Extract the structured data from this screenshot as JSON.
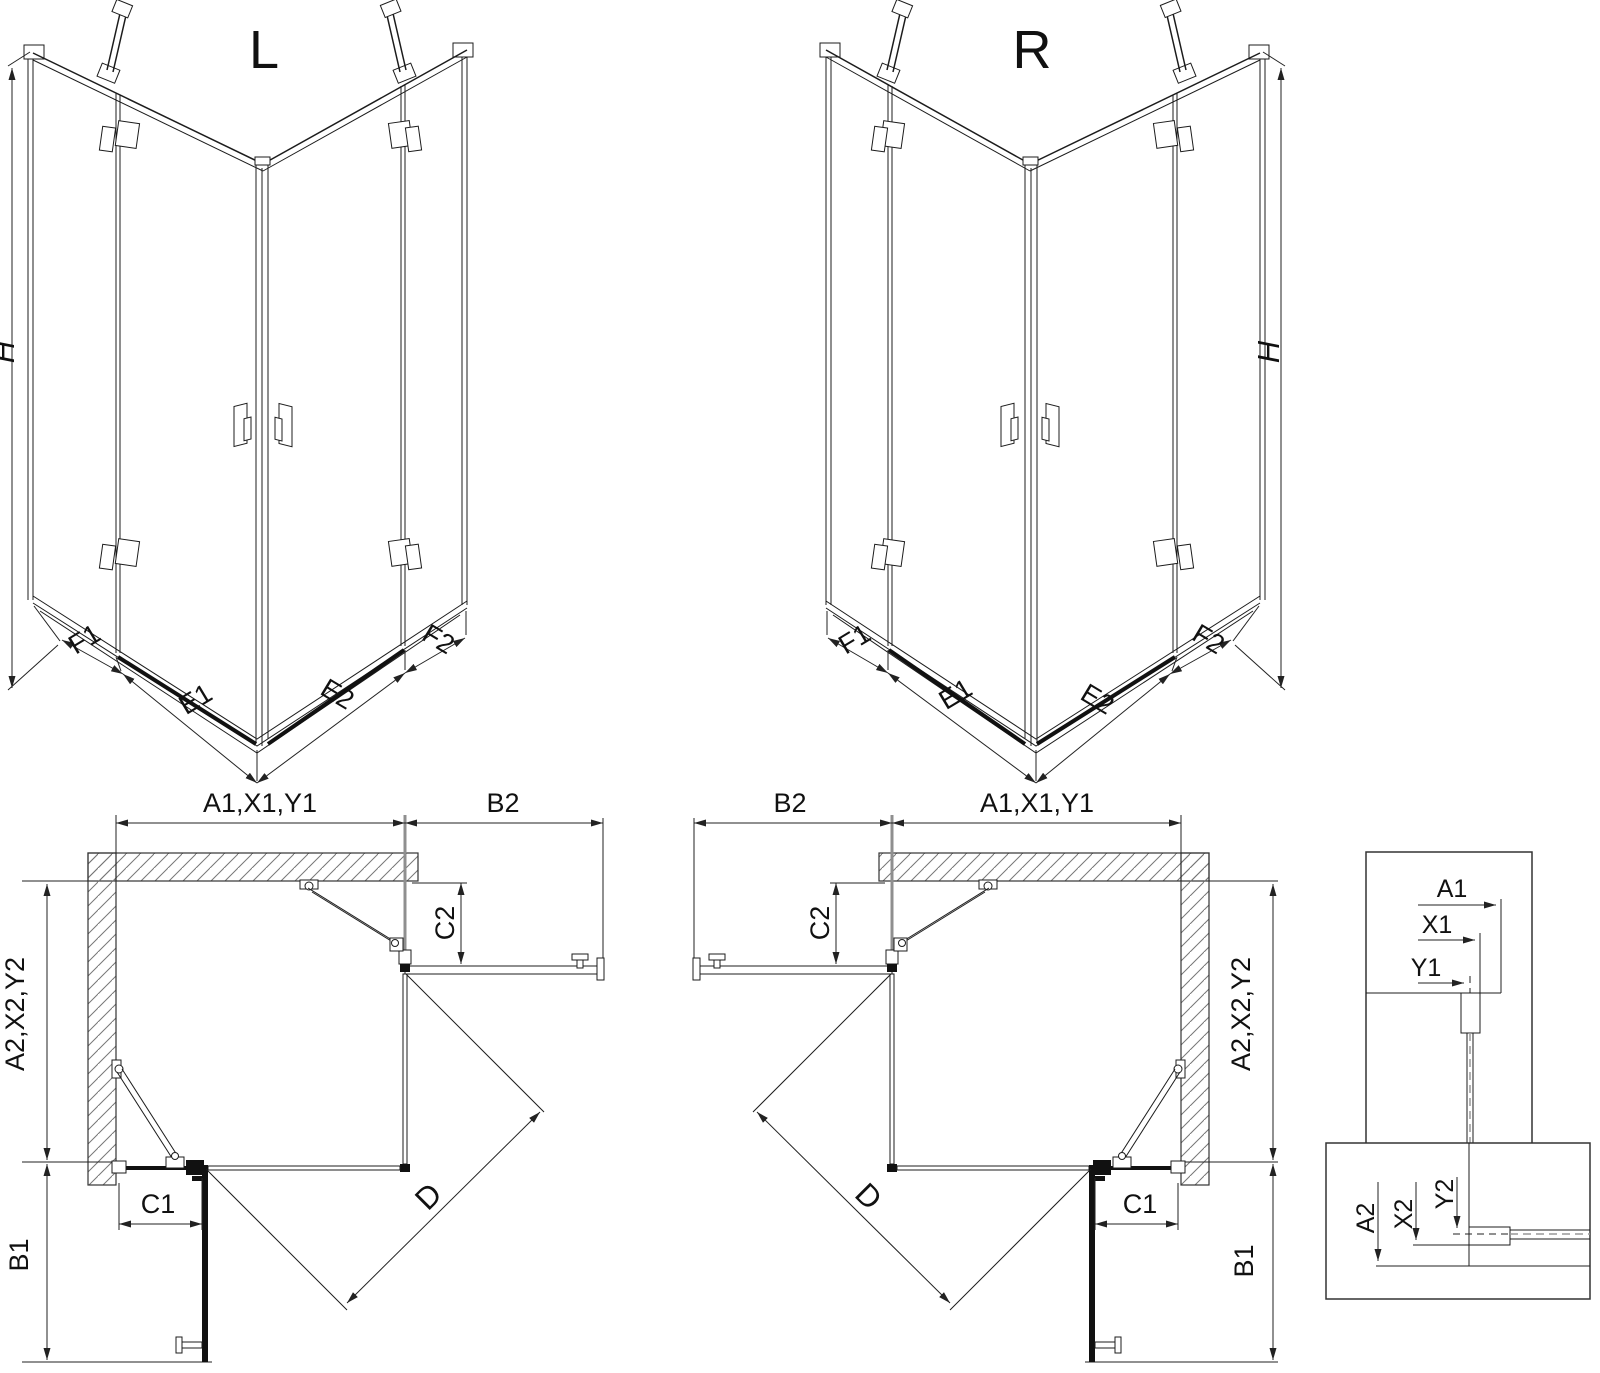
{
  "drawing": {
    "iso_left": {
      "title": "L",
      "height_label": "H",
      "seg_f1": "F1",
      "seg_e1": "E1",
      "seg_e2": "E2",
      "seg_f2": "F2"
    },
    "iso_right": {
      "title": "R",
      "height_label": "H",
      "seg_f2": "F2",
      "seg_e2": "E2",
      "seg_e1": "E1",
      "seg_f1": "F1"
    },
    "plan_left": {
      "width_label": "A1,X1,Y1",
      "open_door_label": "B2",
      "return_panel_label": "C2",
      "depth_label": "A2,X2,Y2",
      "open_door2_label": "B1",
      "fixed_panel_label": "C1",
      "diagonal_label": "D"
    },
    "plan_right": {
      "open_door_label": "B2",
      "width_label": "A1,X1,Y1",
      "return_panel_label": "C2",
      "depth_label": "A2,X2,Y2",
      "open_door2_label": "B1",
      "fixed_panel_label": "C1",
      "diagonal_label": "D"
    },
    "detail_glass_top": {
      "dim_a": "A1",
      "dim_x": "X1",
      "dim_y": "Y1"
    },
    "detail_glass_bottom": {
      "dim_a": "A2",
      "dim_x": "X2",
      "dim_y": "Y2"
    }
  }
}
